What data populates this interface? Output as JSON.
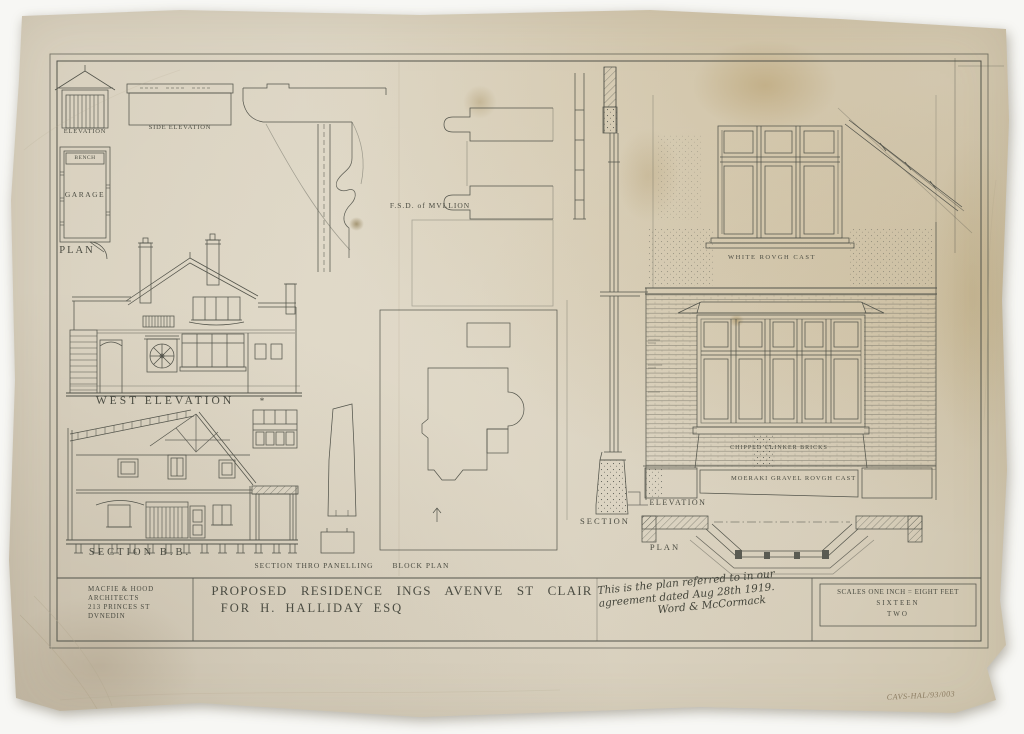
{
  "labels": {
    "garage_elevation": "ELEVATION",
    "garage_side_elevation": "SIDE ELEVATION",
    "garage_bench": "BENCH",
    "garage_room": "GARAGE",
    "garage_plan": "PLAN",
    "west_elevation": "WEST ELEVATION",
    "west_elevation_mark": "*",
    "section_bb": "SECTION B.B.",
    "section_thro_panelling": "SECTION THRO PANELLING",
    "block_plan": "BLOCK PLAN",
    "fsd_of_mullion": "F.S.D. of MVLLION",
    "wall_section": "SECTION",
    "white_rough_cast": "WHITE ROVGH CAST",
    "chipped_clinker_bricks": "CHIPPED CLINKER BRICKS",
    "moeraki_gravel_rough_cast": "MOERAKI GRAVEL ROVGH CAST",
    "bay_elevation": "ELEVATION",
    "bay_plan": "PLAN"
  },
  "title_block": {
    "architect_line1": "MACFIE & HOOD",
    "architect_line2": "ARCHITECTS",
    "architect_line3": "213 PRINCES ST",
    "architect_line4": "DVNEDIN",
    "title_line1": "PROPOSED RESIDENCE INGS AVENVE ST CLAIR",
    "title_line2": "FOR H. HALLIDAY ESQ",
    "note_line1": "This is the plan referred to in our",
    "note_line2": "agreement dated Aug 28th 1919.",
    "note_signature": "Word & McCormack",
    "scale_line1": "SCALES ONE INCH = EIGHT FEET",
    "scale_line2": "SIXTEEN",
    "scale_line3": "TWO"
  },
  "annotations": {
    "archive_ref": "CAVS-HAL/93/003"
  }
}
